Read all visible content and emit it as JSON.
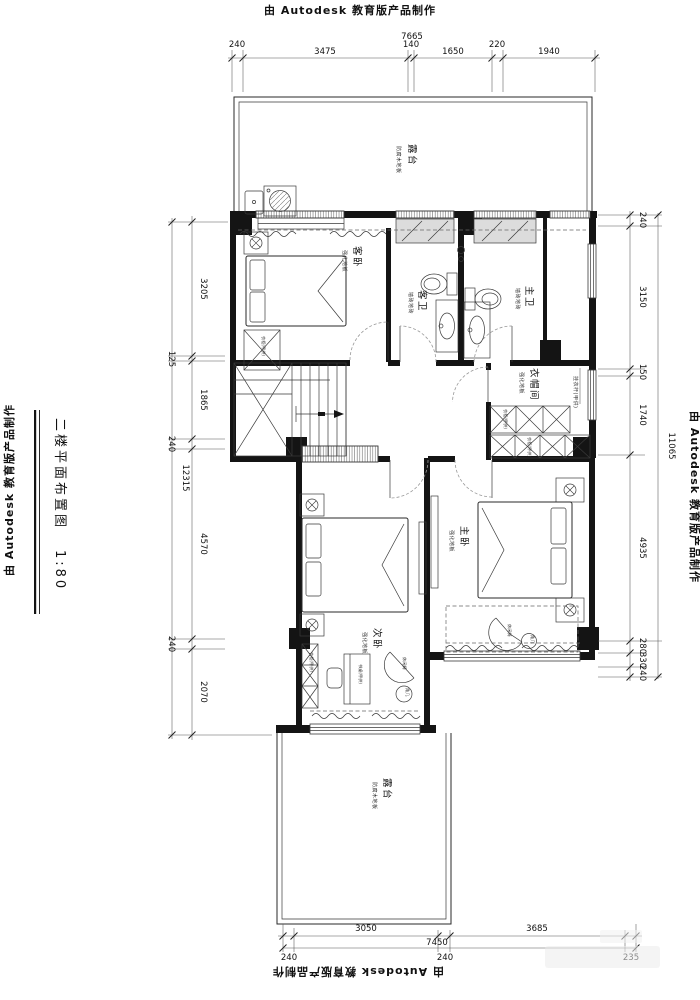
{
  "banner": "由 Autodesk 教育版产品制作",
  "title": {
    "text": "二楼平面布置图",
    "scale": "1:80"
  },
  "rooms": {
    "terrace_top": {
      "name": "露台",
      "finish": "防腐木地板"
    },
    "guest_bedroom": {
      "name": "客卧",
      "finish": "强化地板"
    },
    "guest_bath": {
      "name": "客卫",
      "finish": "墙砖地砖"
    },
    "master_bath": {
      "name": "主卫",
      "finish": "墙砖地砖"
    },
    "cloakroom": {
      "name": "衣帽间",
      "finish": "强化地板"
    },
    "master_bedroom": {
      "name": "主卧",
      "finish": "强化地板"
    },
    "second_bedroom": {
      "name": "次卧",
      "finish": "强化地板"
    },
    "terrace_bottom": {
      "name": "露台",
      "finish": "防腐木地板"
    }
  },
  "furniture": {
    "coat_rod": "挂衣杆(甲供)",
    "wardrobe": "衣柜(甲供)",
    "desk": "书桌(甲供)",
    "lounge_chair": "休闲椅",
    "side_table": "角几"
  },
  "dimensions": {
    "top": {
      "overall": "7665",
      "segments": [
        "240",
        "3475",
        "140",
        "1650",
        "220",
        "1940"
      ]
    },
    "left": {
      "overall": "12315",
      "segments": [
        "3205",
        "125",
        "1865",
        "240",
        "4570",
        "240",
        "2070"
      ]
    },
    "right": {
      "overall": "11065",
      "segments": [
        "240",
        "3150",
        "150",
        "1740",
        "4935",
        "280",
        "330",
        "240"
      ]
    },
    "bottom": {
      "overall": "7450",
      "segments": [
        "3050",
        "3685"
      ],
      "edge": [
        "240",
        "240",
        "235"
      ]
    }
  },
  "colors": {
    "line": "#141414",
    "dim_text": "#111111",
    "sill": "#dcdcdc"
  }
}
